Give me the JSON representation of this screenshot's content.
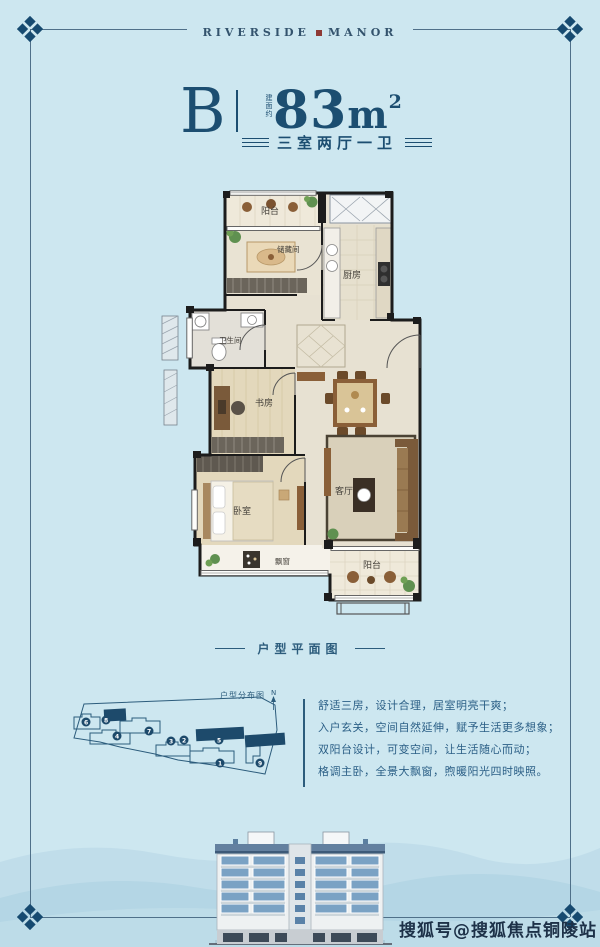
{
  "brand": {
    "left": "RIVERSIDE",
    "right": "MANOR"
  },
  "unit": {
    "letter": "B",
    "area_prefix": "建面约",
    "area_value": "83",
    "area_unit": "m",
    "area_exponent": "2",
    "layout": "三室两厅一卫"
  },
  "floor_plan": {
    "caption": "户型平面图",
    "rooms": {
      "balcony_top": "阳台",
      "storage": "储藏间",
      "kitchen": "厨房",
      "bathroom": "卫生间",
      "study": "书房",
      "bedroom": "卧室",
      "bay_window": "飘窗",
      "living_room": "客厅",
      "balcony_bottom": "阳台"
    }
  },
  "site_plan": {
    "title": "户型分布图",
    "compass": "N",
    "numbers": [
      "6",
      "8",
      "4",
      "7",
      "3",
      "2",
      "5",
      "1",
      "9"
    ]
  },
  "description": {
    "lines": [
      "舒适三房，设计合理，居室明亮干爽；",
      "入户玄关，空间自然延伸，赋予生活更多想象；",
      "双阳台设计，可变空间，让生活随心而动；",
      "格调主卧，全景大飘窗，煦暖阳光四时映照。"
    ]
  },
  "watermark": {
    "text": "搜狐号@搜狐焦点铜陵站"
  },
  "colors": {
    "background": "#cde7f0",
    "accent": "#1c4e71",
    "frame_line": "#4f7089",
    "red_square": "#8e3a35",
    "dark_fill": "#1d4a6b"
  }
}
